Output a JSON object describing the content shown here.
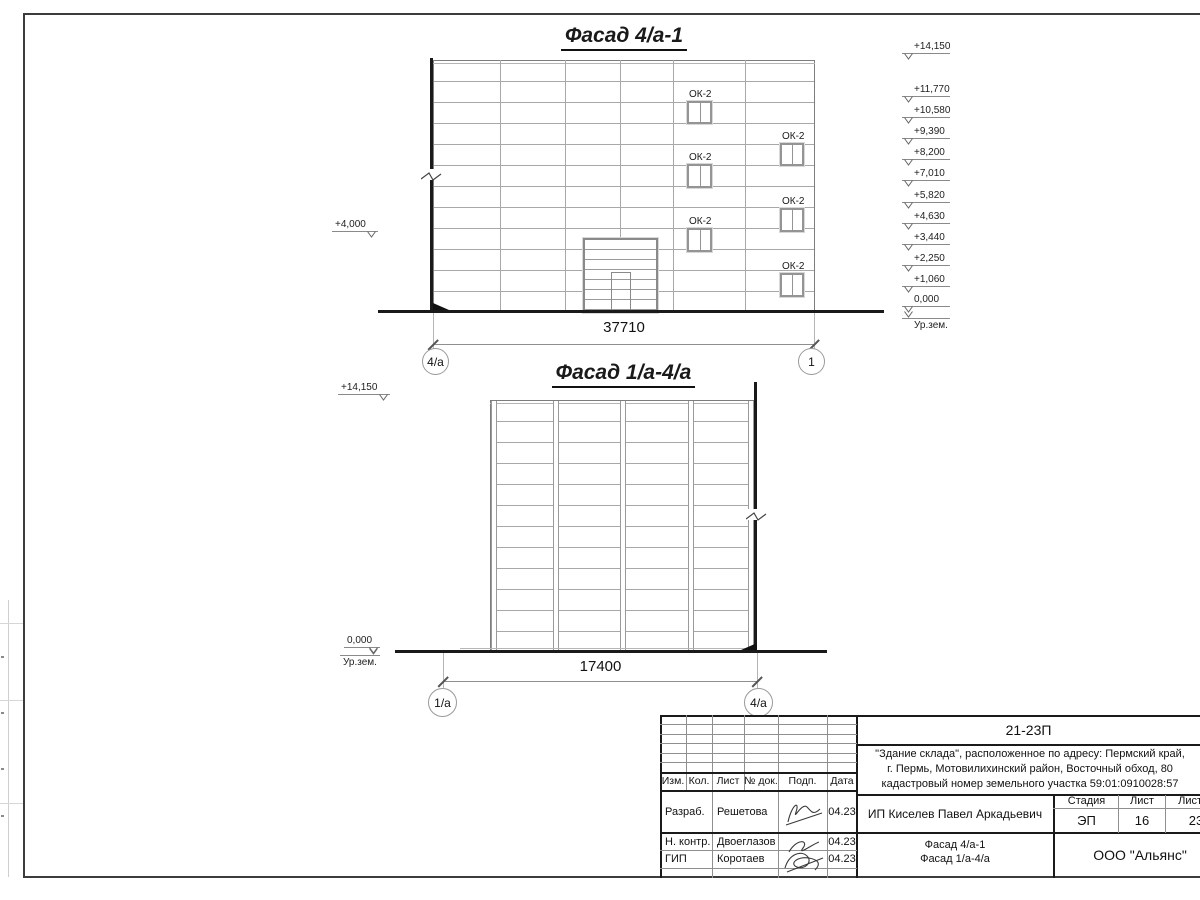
{
  "colors": {
    "line": "#1a1a1a",
    "panel_line": "#a8a8a8"
  },
  "drawing": {
    "facade1": {
      "title": "Фасад 4/а-1",
      "dimension": "37710",
      "axis_left": "4/а",
      "axis_right": "1",
      "window_label": "ОК-2",
      "elev_left": "+4,000",
      "elev_right": [
        "+14,150",
        "+11,770",
        "+10,580",
        "+9,390",
        "+8,200",
        "+7,010",
        "+5,820",
        "+4,630",
        "+3,440",
        "+2,250",
        "+1,060",
        "0,000"
      ],
      "ground_label": "Ур.зем."
    },
    "facade2": {
      "title": "Фасад 1/а-4/а",
      "dimension": "17400",
      "axis_left": "1/а",
      "axis_right": "4/а",
      "elev_top": "+14,150",
      "elev_zero": "0,000",
      "ground_label": "Ур.зем."
    }
  },
  "titleblock": {
    "doc_number": "21-23П",
    "project_line1": "\"Здание склада\", расположенное по адресу: Пермский край,",
    "project_line2": "г. Пермь, Мотовилихинский район, Восточный обход, 80",
    "project_line3": "кадастровый номер земельного участка 59:01:0910028:57",
    "col_izm": "Изм.",
    "col_kol": "Кол.",
    "col_list": "Лист",
    "col_doc": "№ док.",
    "col_podp": "Подп.",
    "col_data": "Дата",
    "row1_role": "Разраб.",
    "row1_name": "Решетова",
    "row1_date": "04.23",
    "row2_role": "Н. контр.",
    "row2_name": "Двоеглазов",
    "row2_date": "04.23",
    "row3_role": "ГИП",
    "row3_name": "Коротаев",
    "row3_date": "04.23",
    "client": "ИП Киселев Павел Аркадьевич",
    "stage_label": "Стадия",
    "sheet_label": "Лист",
    "sheets_label": "Листов",
    "stage": "ЭП",
    "sheet": "16",
    "sheets": "23",
    "sheet_title1": "Фасад 4/а-1",
    "sheet_title2": "Фасад 1/а-4/а",
    "company": "ООО \"Альянс\""
  }
}
